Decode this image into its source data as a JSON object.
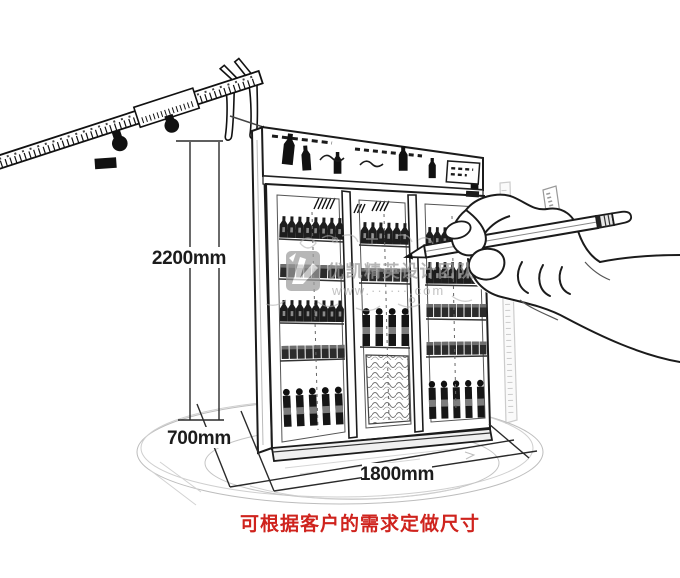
{
  "illustration": {
    "caption": "可根据客户的需求定做尺寸",
    "dimensions": {
      "height": "2200mm",
      "depth": "700mm",
      "width": "1800mm"
    },
    "watermark": {
      "brand": "优凯精英设计团队",
      "site": "www.······.com"
    },
    "colors": {
      "caption_red": "#cf231d",
      "sketch_black": "#1b1b1b",
      "watermark_gray": "#9a9a9a"
    },
    "icons": [
      "vernier-caliper-sketch",
      "three-door-display-cooler-sketch",
      "hand-holding-pencil-sketch",
      "floor-ellipse-sketch"
    ]
  }
}
